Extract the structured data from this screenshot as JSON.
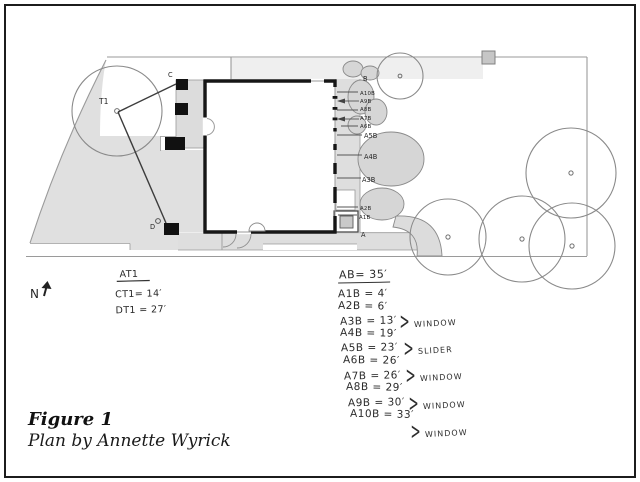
{
  "figure": {
    "title": "Figure 1",
    "subtitle": "Plan by Annette Wyrick"
  },
  "compass": {
    "label": "N"
  },
  "tree_measurements": {
    "title": "AT1",
    "ct1": "CT1= 14′",
    "dt1": "DT1 = 27′"
  },
  "plan_labels": {
    "t1": "T1",
    "c": "C",
    "d": "D",
    "b": "B",
    "a": "A",
    "a10b": "A10B",
    "a9b": "A9B",
    "a8b": "A8B",
    "a7b": "A7B",
    "a6b": "A6B",
    "a5b": "A5B",
    "a4b": "A4B",
    "a3b": "A3B",
    "a2b": "A2B",
    "a1b": "A1B"
  },
  "legend": {
    "header": "AB= 35′",
    "rows": [
      "A1B = 4′",
      "A2B = 6′",
      "A3B = 13′",
      "A4B = 19′",
      "A5B = 23′",
      "A6B = 26′",
      "A7B = 26′",
      "A8B = 29′",
      "A9B = 30′",
      "A10B = 33′"
    ],
    "annotations": [
      {
        "brace": ">",
        "text": "WINDOW"
      },
      {
        "brace": ">",
        "text": "SLIDER"
      },
      {
        "brace": ">",
        "text": "WINDOW"
      },
      {
        "brace": ">",
        "text": "WINDOW"
      },
      {
        "brace": ">",
        "text": "WINDOW"
      }
    ]
  },
  "colors": {
    "ink": "#1c1c1c",
    "site_line": "#9a9a9a",
    "fill_paving": "#e0e0e0",
    "fill_shrub": "#d6d6d6",
    "wall": "#161616"
  }
}
